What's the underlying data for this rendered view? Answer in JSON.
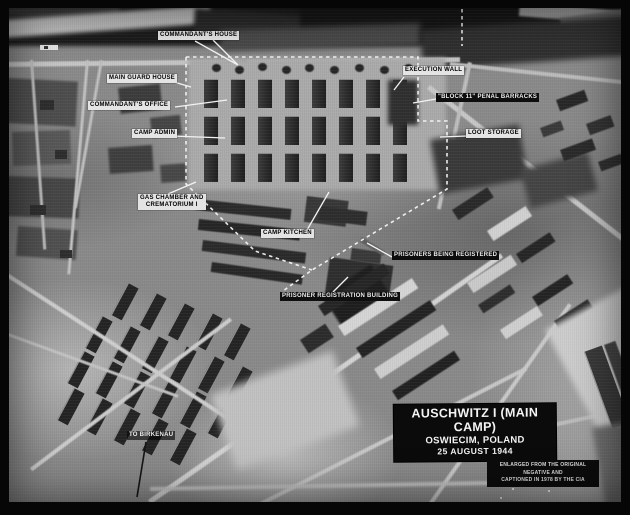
{
  "photo": {
    "description": "Annotated aerial reconnaissance photograph",
    "labels": {
      "commandants_house": "COMMANDANT'S HOUSE",
      "main_guard_house": "MAIN GUARD HOUSE",
      "commandants_office": "COMMANDANT'S OFFICE",
      "camp_admin": "CAMP ADMIN",
      "execution_wall": "EXECUTION WALL",
      "block_11_penal_barracks": "\"BLOCK 11\" PENAL BARRACKS",
      "loot_storage": "LOOT STORAGE",
      "gas_chamber_line1": "GAS CHAMBER AND",
      "gas_chamber_line2": "CREMATORIUM I",
      "camp_kitchen": "CAMP KITCHEN",
      "prisoners_being_registered": "PRISONERS BEING REGISTERED",
      "prisoner_registration_building": "PRISONER REGISTRATION BUILDING",
      "to_birkenau": "TO BIRKENAU"
    },
    "title_block": {
      "line1": "AUSCHWITZ I (MAIN CAMP)",
      "line2": "OSWIECIM, POLAND",
      "line3": "25 AUGUST 1944"
    },
    "credit_block": {
      "line1": "ENLARGED FROM THE ORIGINAL NEGATIVE AND",
      "line2": "CAPTIONED IN 1978 BY THE CIA"
    }
  }
}
